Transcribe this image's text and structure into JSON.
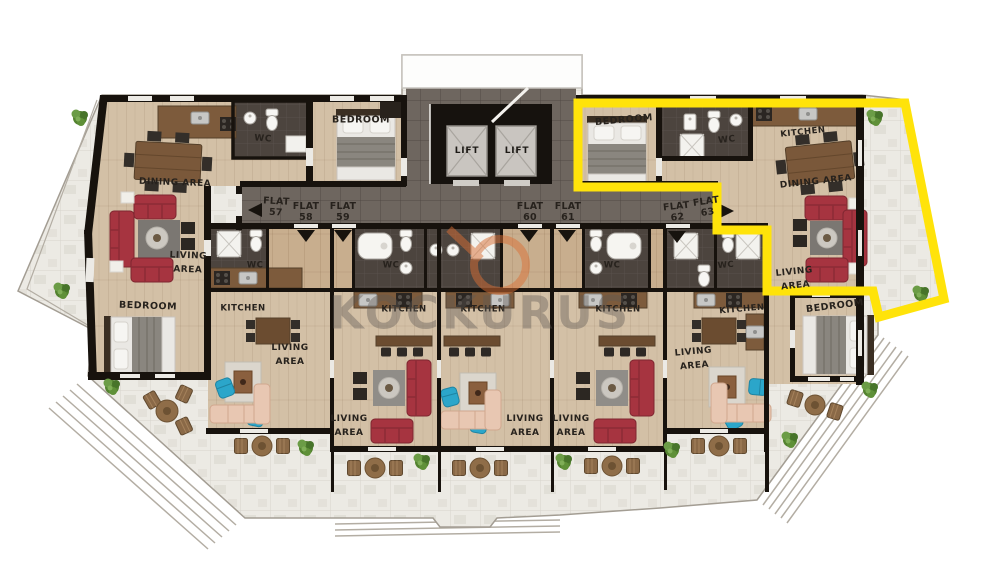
{
  "plan_title": "Floor plan flats 57-63",
  "watermark": {
    "text": "KOCKURUS",
    "ring_color": "#d96f35",
    "text_color": "#5f5954"
  },
  "highlight": {
    "flat_number": "63",
    "color": "#ffe30a"
  },
  "lifts": [
    {
      "name": "lift-1-label",
      "text": "LIFT",
      "x": 467,
      "y": 152,
      "rot": 0,
      "fs": 9
    },
    {
      "name": "lift-2-label",
      "text": "LIFT",
      "x": 517,
      "y": 152,
      "rot": 0,
      "fs": 9
    }
  ],
  "flats": [
    {
      "name": "flat-57-label",
      "text": "FLAT\n57",
      "x": 276,
      "y": 208,
      "rot": 3,
      "fs": 9.5
    },
    {
      "name": "flat-58-label",
      "text": "FLAT\n58",
      "x": 306,
      "y": 213,
      "rot": 0,
      "fs": 9.5
    },
    {
      "name": "flat-59-label",
      "text": "FLAT\n59",
      "x": 343,
      "y": 213,
      "rot": 0,
      "fs": 9.5
    },
    {
      "name": "flat-60-label",
      "text": "FLAT\n60",
      "x": 530,
      "y": 213,
      "rot": 0,
      "fs": 9.5
    },
    {
      "name": "flat-61-label",
      "text": "FLAT\n61",
      "x": 568,
      "y": 213,
      "rot": 0,
      "fs": 9.5
    },
    {
      "name": "flat-62-label",
      "text": "FLAT\n62",
      "x": 677,
      "y": 213,
      "rot": -6,
      "fs": 9.5
    },
    {
      "name": "flat-63-label",
      "text": "FLAT\n63",
      "x": 707,
      "y": 208,
      "rot": -8,
      "fs": 9.5
    }
  ],
  "room_labels": [
    {
      "name": "label-wc-flat57",
      "text": "WC",
      "x": 263,
      "y": 140,
      "rot": 4,
      "fs": 9
    },
    {
      "name": "label-dining-area-flat57",
      "text": "DINING AREA",
      "x": 175,
      "y": 184,
      "rot": 2,
      "fs": 9
    },
    {
      "name": "label-bedroom-top",
      "text": "BEDROOM",
      "x": 361,
      "y": 121,
      "rot": 0,
      "fs": 9.5
    },
    {
      "name": "label-living-area-flat57",
      "text": "LIVING\nAREA",
      "x": 188,
      "y": 264,
      "rot": 2,
      "fs": 9
    },
    {
      "name": "label-bedroom-flat57",
      "text": "BEDROOM",
      "x": 148,
      "y": 307,
      "rot": 2,
      "fs": 9.5
    },
    {
      "name": "label-wc-flat58",
      "text": "WC",
      "x": 255,
      "y": 266,
      "rot": 0,
      "fs": 8.5
    },
    {
      "name": "label-kitchen-flat58",
      "text": "KITCHEN",
      "x": 243,
      "y": 309,
      "rot": 0,
      "fs": 8.5
    },
    {
      "name": "label-living-area-flat58",
      "text": "LIVING\nAREA",
      "x": 290,
      "y": 356,
      "rot": 0,
      "fs": 9
    },
    {
      "name": "label-wc-flat59",
      "text": "WC",
      "x": 391,
      "y": 266,
      "rot": 0,
      "fs": 8.5
    },
    {
      "name": "label-kitchen-flat59",
      "text": "KITCHEN",
      "x": 404,
      "y": 310,
      "rot": 0,
      "fs": 8.5
    },
    {
      "name": "label-living-area-flat59",
      "text": "LIVING\nAREA",
      "x": 349,
      "y": 427,
      "rot": 0,
      "fs": 9
    },
    {
      "name": "label-kitchen-flat60",
      "text": "KITCHEN",
      "x": 483,
      "y": 310,
      "rot": 0,
      "fs": 8.5
    },
    {
      "name": "label-living-area-flat60",
      "text": "LIVING\nAREA",
      "x": 525,
      "y": 427,
      "rot": 0,
      "fs": 9
    },
    {
      "name": "label-wc-flat61",
      "text": "WC",
      "x": 612,
      "y": 266,
      "rot": 0,
      "fs": 8.5
    },
    {
      "name": "label-kitchen-flat61",
      "text": "KITCHEN",
      "x": 618,
      "y": 310,
      "rot": 0,
      "fs": 8.5
    },
    {
      "name": "label-living-area-flat61",
      "text": "LIVING\nAREA",
      "x": 571,
      "y": 427,
      "rot": 0,
      "fs": 9
    },
    {
      "name": "label-wc-flat62",
      "text": "WC",
      "x": 726,
      "y": 266,
      "rot": -5,
      "fs": 8.5
    },
    {
      "name": "label-kitchen-flat62",
      "text": "KITCHEN",
      "x": 742,
      "y": 310,
      "rot": -5,
      "fs": 8.5
    },
    {
      "name": "label-living-area-flat62",
      "text": "LIVING\nAREA",
      "x": 694,
      "y": 360,
      "rot": -5,
      "fs": 9
    },
    {
      "name": "label-bedroom-flat63",
      "text": "BEDROOM",
      "x": 624,
      "y": 121,
      "rot": -5,
      "fs": 9.5
    },
    {
      "name": "label-wc-flat63",
      "text": "WC",
      "x": 727,
      "y": 141,
      "rot": -6,
      "fs": 9
    },
    {
      "name": "label-kitchen-flat63",
      "text": "KITCHEN",
      "x": 803,
      "y": 133,
      "rot": -6,
      "fs": 8.5
    },
    {
      "name": "label-dining-area-flat63",
      "text": "DINING AREA",
      "x": 816,
      "y": 183,
      "rot": -6,
      "fs": 9
    },
    {
      "name": "label-living-area-flat63",
      "text": "LIVING\nAREA",
      "x": 795,
      "y": 280,
      "rot": -6,
      "fs": 9
    },
    {
      "name": "label-bedroom-flat62",
      "text": "BEDROOM",
      "x": 835,
      "y": 307,
      "rot": -7,
      "fs": 9.5
    }
  ],
  "palette": {
    "wood": "#d3c0a6",
    "corridor_tile": "#6e665f",
    "bath_tile": "#4c443e",
    "marble": "#eceae4",
    "wall": "#17120d",
    "sofa_red": "#a63440",
    "accent_teal": "#2ba6ca",
    "plant_green": "#53822f",
    "highlight_yellow": "#ffe30a",
    "watermark_orange": "#d96f35"
  }
}
